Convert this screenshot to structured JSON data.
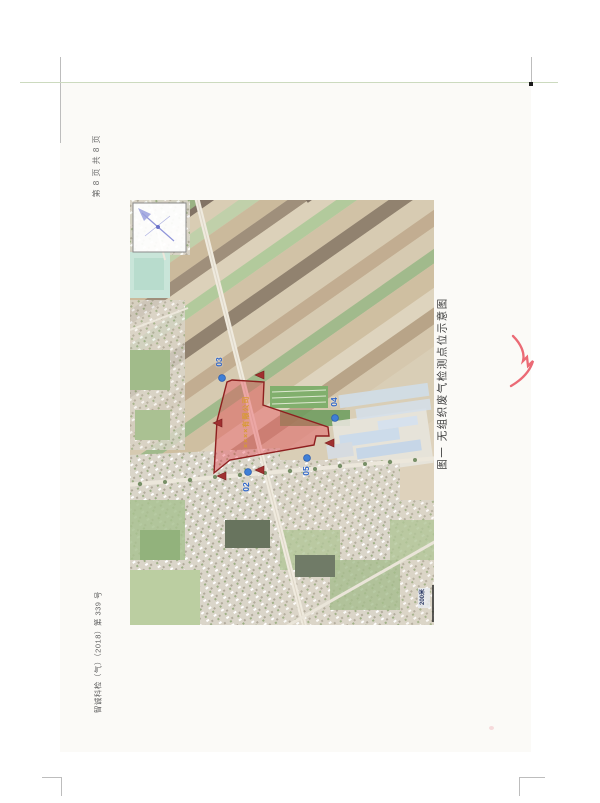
{
  "document": {
    "page_header": "第 8 页  共 8 页",
    "doc_number": "智诚科检（气）（2018）第 339 号",
    "figure_caption": "图一  无组织废气检测点位示意图"
  },
  "map": {
    "site_label": "××××有限公司",
    "scale_label": "200米",
    "markers": {
      "m02": {
        "label": "02"
      },
      "m03": {
        "label": "03"
      },
      "m04": {
        "label": "04"
      },
      "m05": {
        "label": "05"
      }
    }
  },
  "colors": {
    "site_fill": "#e84a55",
    "site_border": "#8e1f1f",
    "marker_blue": "#3f7fd6",
    "triangle_red": "#a03030",
    "signature_red": "#e8505e",
    "label_orange": "#d89b2f"
  }
}
